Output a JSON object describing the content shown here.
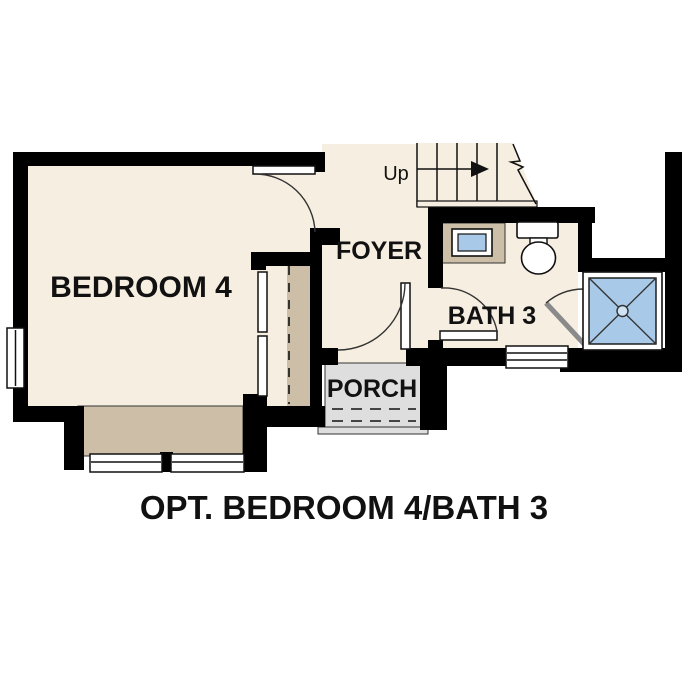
{
  "plan": {
    "caption": "OPT. BEDROOM 4/BATH 3",
    "labels": {
      "bedroom": "BEDROOM 4",
      "foyer": "FOYER",
      "bath": "BATH 3",
      "porch": "PORCH",
      "stairs_direction": "Up"
    },
    "colors": {
      "wall": "#000000",
      "floor": "#f6eee1",
      "accent_tan": "#cdbfa7",
      "porch_gray": "#dedede",
      "fixture_blue": "#a9c9e8",
      "line": "#333333",
      "background": "#ffffff"
    },
    "fixtures": [
      "stairs-up-with-break-line",
      "bedroom-closet-bypass-doors",
      "bay-window-seat-two-windows",
      "left-wall-window",
      "bath-window",
      "vanity-sink",
      "toilet",
      "shower-with-pivot-door",
      "front-door-to-porch",
      "bedroom-door",
      "bath-door",
      "porch-steps"
    ]
  }
}
